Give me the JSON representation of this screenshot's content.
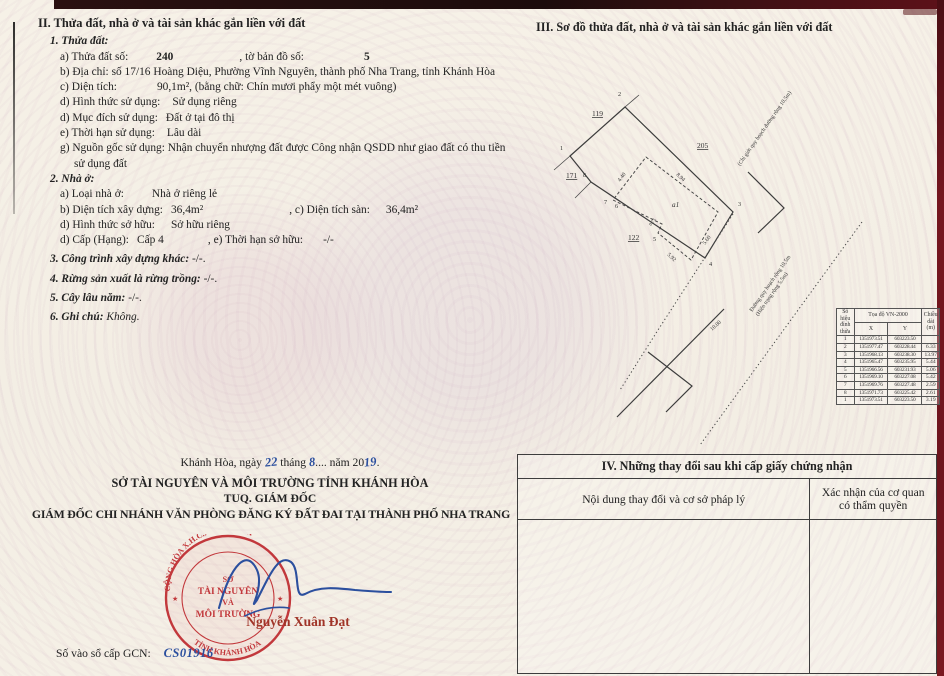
{
  "section_ii": {
    "title": "II. Thửa đất, nhà ở và tài sản khác gắn liền với đất",
    "land": {
      "heading": "1. Thửa đất:",
      "a_label": "a) Thửa đất số:",
      "a_value": "240",
      "a2_label": ", tờ bản đồ số:",
      "a2_value": "5",
      "b_label": "b) Địa chỉ:",
      "b_value": "số 17/16  Hoàng Diệu, Phường Vĩnh Nguyên, thành phố Nha Trang, tỉnh Khánh Hòa",
      "c_label": "c) Diện tích:",
      "c_value": "90,1m²,",
      "c_words": "(bằng chữ: Chín mươi phẩy một mét vuông)",
      "d1_label": "d) Hình thức sử dụng:",
      "d1_value": "Sử dụng riêng",
      "d2_label": "d) Mục đích sử dụng:",
      "d2_value": "Đất ở tại đô thị",
      "e_label": "e) Thời hạn sử dụng:",
      "e_value": "Lâu dài",
      "g_label": "g) Nguồn gốc sử dụng:",
      "g_value": "Nhận chuyển nhượng đất được Công nhận QSDD như giao đất có thu tiền sử dụng đất"
    },
    "house": {
      "heading": "2. Nhà ở:",
      "a_label": "a) Loại nhà ở:",
      "a_value": "Nhà ở riêng lẻ",
      "b_label": "b) Diện tích xây dựng:",
      "b_value": "36,4m²",
      "c_label": ", c) Diện tích sàn:",
      "c_value": "36,4m²",
      "d1_label": "d) Hình thức sở hữu:",
      "d1_value": "Sở hữu riêng",
      "d2_label": "d) Cấp (Hạng):",
      "d2_value": "Cấp 4",
      "e_label": ", e) Thời hạn sở hữu:",
      "e_value": "-/-"
    },
    "item3_label": "3. Công trình xây dựng khác:",
    "item3_value": "-/-.",
    "item4_label": "4. Rừng sản xuất là rừng trồng:",
    "item4_value": "-/-.",
    "item5_label": "5. Cây lâu năm:",
    "item5_value": "-/-.",
    "item6_label": "6. Ghi chú:",
    "item6_value": "Không."
  },
  "section_iii": {
    "title": "III. Sơ đồ thửa đất, nhà ở và tài sản khác gắn liền với đất",
    "diagram": {
      "parcel_119": "119",
      "parcel_171": "171",
      "parcel_122": "122",
      "parcel_205": "205",
      "v1": "1",
      "v2": "2",
      "v3": "3",
      "v4": "4",
      "v5": "5",
      "v6": "6",
      "v7": "7",
      "v8": "8",
      "house_label": "a1",
      "dim_top": "8.94",
      "dim_left": "4.40",
      "dim_right": "5.60",
      "dim_bottom": "5.92",
      "dim_step": "0.75",
      "road_width": "10.00",
      "boundary_text": "(Chỉ giới quy hoạch đường rộng 10,5m)",
      "road_text_1": "Đường quy hoạch rộng 10,5m",
      "road_text_2": "(Hiện trạng rộng 5,5m)"
    },
    "coord_table": {
      "col_vertex": "Số hiệu đỉnh thửa",
      "col_coords": "Tọa độ VN-2000",
      "col_x": "X",
      "col_y": "Y",
      "col_len": "Chiều dài (m)",
      "rows": [
        {
          "n": "1",
          "x": "1351973.51",
          "y": "603223.50",
          "d": ""
        },
        {
          "n": "2",
          "x": "1351977.47",
          "y": "603228.44",
          "d": "6.33"
        },
        {
          "n": "3",
          "x": "1351968.13",
          "y": "603238.30",
          "d": "13.97"
        },
        {
          "n": "4",
          "x": "1351965.47",
          "y": "603235.95",
          "d": "5.44"
        },
        {
          "n": "5",
          "x": "1351966.56",
          "y": "603231.93",
          "d": "5.06"
        },
        {
          "n": "6",
          "x": "1351969.10",
          "y": "603227.08",
          "d": "5.42"
        },
        {
          "n": "7",
          "x": "1351969.76",
          "y": "603227.48",
          "d": "2.59"
        },
        {
          "n": "8",
          "x": "1351971.73",
          "y": "603225.42",
          "d": "2.61"
        },
        {
          "n": "1",
          "x": "1351973.51",
          "y": "603223.50",
          "d": "3.19"
        }
      ]
    }
  },
  "section_iv": {
    "title": "IV. Những thay đổi sau khi cấp giấy chứng nhận",
    "col1": "Nội dung thay đổi và cơ sở pháp lý",
    "col2": "Xác nhận của cơ quan có thẩm quyền"
  },
  "signing": {
    "date_prefix": "Khánh Hòa, ngày",
    "day": "22",
    "month_label": "tháng",
    "month": "8",
    "dots": "....",
    "year_label": "năm 20",
    "year": "19",
    "period": ".",
    "org": "SỞ TÀI NGUYÊN VÀ MÔI TRƯỜNG TỈNH KHÁNH HÒA",
    "tuq": "TUQ. GIÁM ĐỐC",
    "role": "GIÁM ĐỐC CHI NHÁNH VĂN PHÒNG ĐĂNG KÝ ĐẤT ĐAI TẠI THÀNH PHỐ NHA TRANG",
    "signer": "Nguyễn Xuân Đạt",
    "stamp": {
      "arc_top": "CỘNG HÒA X.H.C.N VIỆT NAM",
      "arc_bottom": "TỈNH KHÁNH HÒA",
      "line1": "SỞ",
      "line2": "TÀI NGUYÊN",
      "line3": "VÀ",
      "line4": "MÔI TRƯỜNG",
      "star": "★"
    }
  },
  "footer": {
    "gcn_label": "Số vào sổ cấp GCN:",
    "gcn_value": "CS01916"
  },
  "colors": {
    "stamp_red": "#c2383c",
    "ink_blue": "#2b4f9e",
    "signer_red": "#a03428",
    "cover_maroon": "#6d141d"
  }
}
